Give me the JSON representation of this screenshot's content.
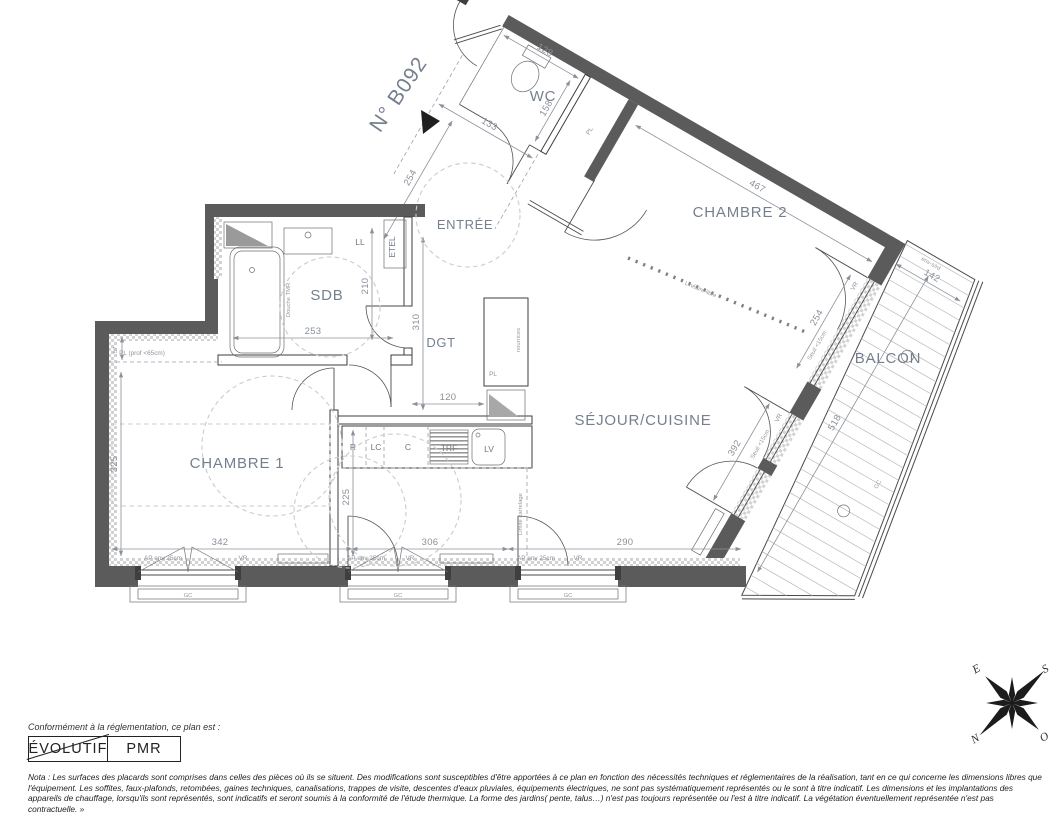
{
  "colors": {
    "wall": "#5b5b5b",
    "room_label": "#75808f",
    "dimension": "#8b909a",
    "accent_black": "#1f1f1f",
    "dashed_circle": "#cbcbcb"
  },
  "title": {
    "unit_number": "N° B092"
  },
  "rooms": {
    "wc": "WC",
    "entree": "ENTRÉE",
    "chambre2": "CHAMBRE 2",
    "sdb": "SDB",
    "dgt": "DGT",
    "sejour_cuisine": "SÉJOUR/CUISINE",
    "chambre1": "CHAMBRE 1",
    "balcon": "BALCON"
  },
  "fixtures": {
    "ll": "LL",
    "etel": "ETEL",
    "pl": "PL",
    "pl_prof": "PL (prof <65cm)",
    "nourrices": "nourrices",
    "douche": "Douche TMR",
    "r": "R",
    "lc": "LC",
    "c": "C",
    "trf": "TRF",
    "lv": "LV",
    "gc": "GC"
  },
  "dims": {
    "wc_width": "128",
    "wc_depth": "158",
    "entree_width": "133",
    "entree_length": "254",
    "chambre2_width": "467",
    "chambre2_window": "254",
    "balcon_width": "142",
    "balcon_length": "518",
    "sdb_width": "253",
    "sdb_depth": "210",
    "placard_depth": "57",
    "dgt_length": "310",
    "dgt_width": "120",
    "chambre1_depth": "325",
    "chambre1_width": "342",
    "cuisine_depth": "225",
    "sejour_window": "392",
    "facade_mid": "306",
    "facade_right": "290"
  },
  "annotations": {
    "ap": "AP env 25cm",
    "vr": "VR",
    "seuil": "Seuil <15cm",
    "lineaire_libre": "Linéaire libre",
    "limite_carrelage": "Limite carrelage",
    "env": "env-s/rd"
  },
  "compass": {
    "n": "N",
    "s": "S",
    "e": "E",
    "o": "O"
  },
  "legend": {
    "intro": "Conformément à la réglementation, ce plan est :",
    "evolutif": "ÉVOLUTIF",
    "pmr": "PMR",
    "nota": "Nota : Les surfaces des placards sont comprises dans celles des pièces où ils se situent. Des modifications sont susceptibles d'être apportées à ce plan en fonction des nécessités techniques et réglementaires de la réalisation, tant en ce qui concerne les dimensions libres que l'équipement.  Les soffites, faux-plafonds, retombées, gaines techniques, canalisations, trappes de visite, descentes d'eaux pluviales, équipements électriques, ne sont pas systématiquement représentés ou le sont à titre indicatif. Les dimensions et les implantations des appareils de chauffage, lorsqu'ils sont représentés, sont indicatifs et seront soumis à la conformité de l'étude thermique. La forme des jardins( pente, talus…) n'est pas toujours représentée ou l'est à titre indicatif. La végétation éventuellement représentée n'est pas contractuelle. »"
  }
}
